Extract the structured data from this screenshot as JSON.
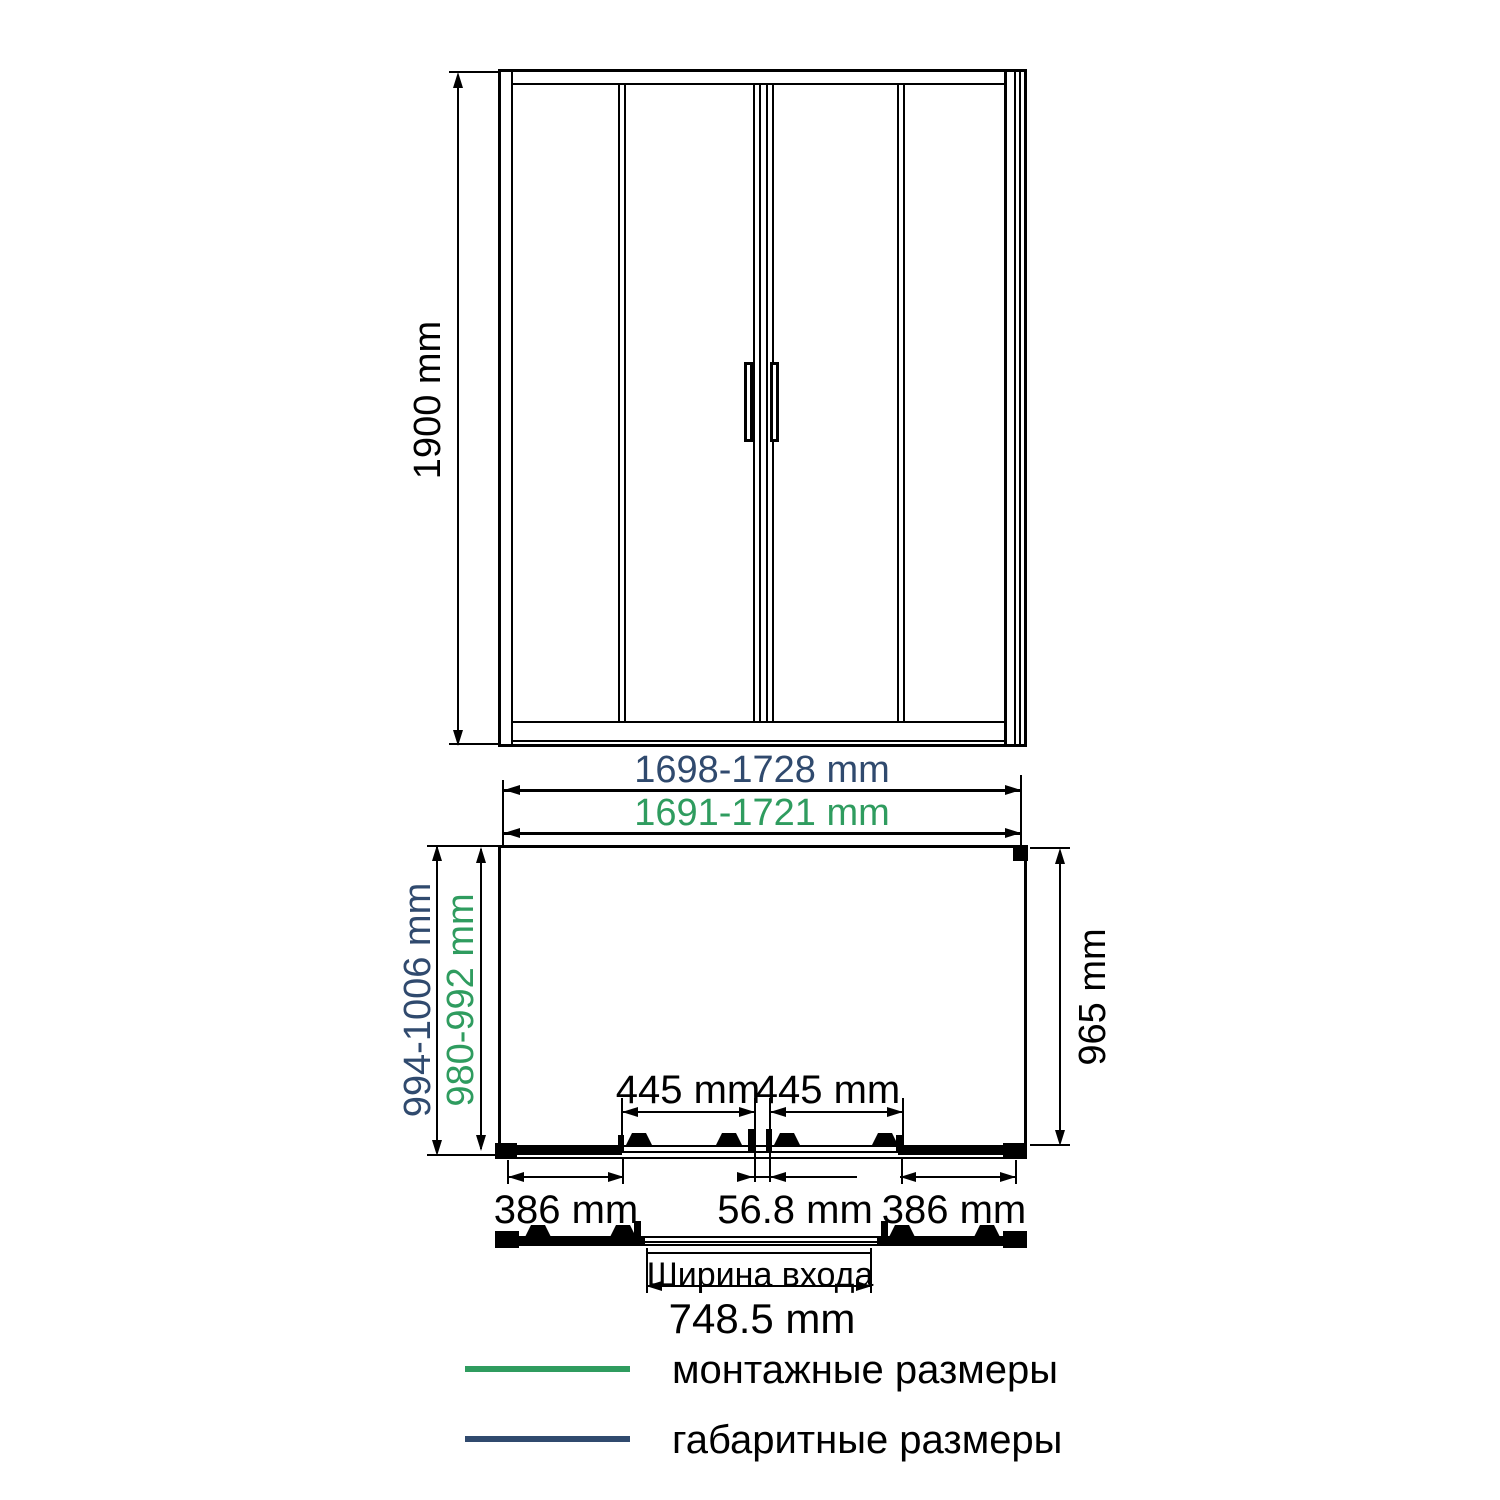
{
  "colors": {
    "mounting_green": "#2f9c5f",
    "overall_navy": "#304a6e",
    "line_black": "#000000"
  },
  "elevation": {
    "height_label": "1900 mm"
  },
  "plan": {
    "width_overall_label": "1698-1728 mm",
    "width_mounting_label": "1691-1721 mm",
    "depth_overall_label": "994-1006 mm",
    "depth_mounting_label": "980-992 mm",
    "side_panel_depth_label": "965 mm",
    "door_panel_left_label": "445 mm",
    "door_panel_right_label": "445 mm",
    "fixed_panel_left_label": "386 mm",
    "center_overlap_label": "56.8 mm",
    "fixed_panel_right_label": "386 mm",
    "entrance_caption": "Ширина входа",
    "entrance_width_label": "748.5 mm"
  },
  "legend": {
    "items": [
      {
        "label": "монтажные размеры",
        "color": "#2f9c5f"
      },
      {
        "label": "габаритные размеры",
        "color": "#304a6e"
      }
    ]
  }
}
